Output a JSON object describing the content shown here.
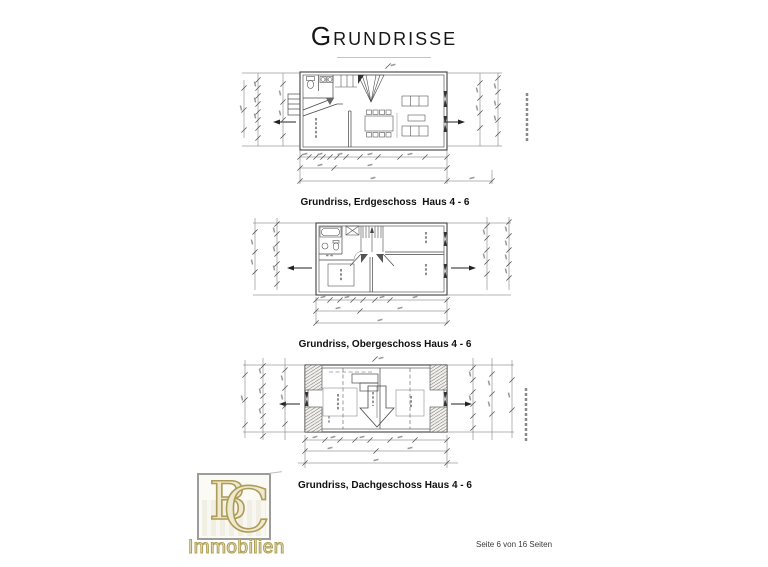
{
  "page": {
    "title": "Grundrisse",
    "footer": "Seite 6 von 16 Seiten"
  },
  "figures": [
    {
      "caption": "Grundriss, Erdgeschoss  Haus 4 - 6"
    },
    {
      "caption": "Grundriss, Obergeschoss Haus 4 - 6"
    },
    {
      "caption": "Grundriss, Dachgeschoss Haus 4 - 6"
    }
  ],
  "logo": {
    "monogram_b": "B",
    "monogram_c": "C",
    "wordmark": "Immobilien"
  },
  "colors": {
    "logo_gold": "#ac9c55",
    "drawing_ink": "#3f3f3f",
    "dimension_line": "#6b6b6b",
    "underline_gray": "#c4c4c4"
  }
}
